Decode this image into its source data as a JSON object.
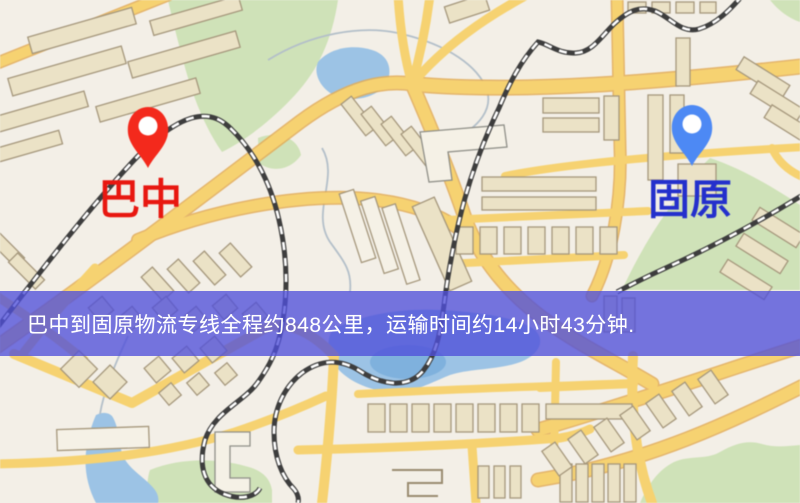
{
  "map": {
    "background_color": "#f3efe7",
    "road_color": "#f6d271",
    "road_casing_color": "#e2ab57",
    "park_color": "#cfe2b8",
    "water_color": "#9cc3e5",
    "railway_color": "#3d3d3d",
    "building_color": "#ebe2c6"
  },
  "markers": {
    "origin": {
      "label": "巴中",
      "pin_color": "#f3291c",
      "label_color": "#e81710"
    },
    "destination": {
      "label": "固原",
      "pin_color": "#4d89f4",
      "label_color": "#2430cc"
    }
  },
  "banner": {
    "text": "巴中到固原物流专线全程约848公里，运输时间约14小时43分钟.",
    "background_color": "rgba(80,79,218,0.78)",
    "text_color": "#ffffff",
    "distance_km": "848",
    "duration_text": "14小时43分钟"
  }
}
